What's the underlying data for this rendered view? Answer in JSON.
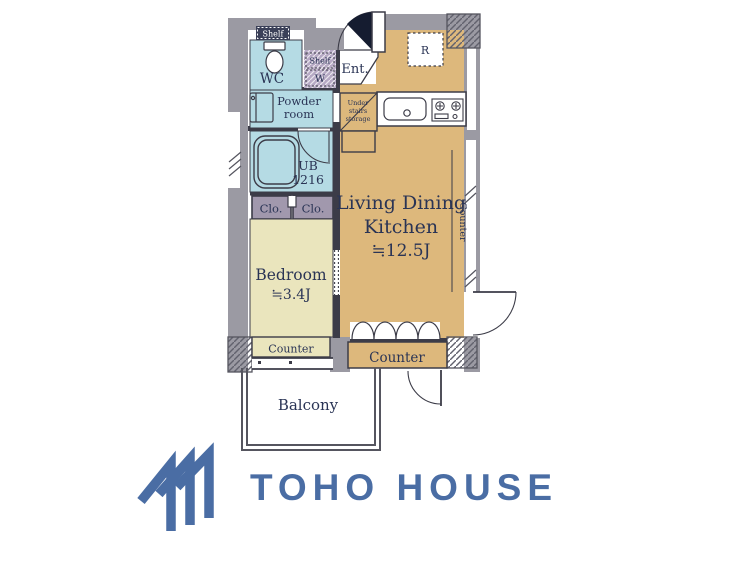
{
  "floor_plan": {
    "labels": {
      "shelf_top": "Shelf",
      "wc": "WC",
      "shelf_w_line1": "Shelf",
      "shelf_w_line2": "W",
      "entrance": "Ent.",
      "refrigerator": "R",
      "powder_line1": "Powder",
      "powder_line2": "room",
      "under_stairs_line1": "Under",
      "under_stairs_line2": "stairs",
      "under_stairs_line3": "storage",
      "unit_bath_line1": "UB",
      "unit_bath_line2": "1216",
      "closet_left": "Clo.",
      "closet_right": "Clo.",
      "ldk_line1": "Living Dining",
      "ldk_line2": "Kitchen",
      "ldk_size": "≒12.5J",
      "counter_right": "Counter",
      "bedroom_line1": "Bedroom",
      "bedroom_size": "≒3.4J",
      "counter_bedroom": "Counter",
      "counter_ldk": "Counter",
      "balcony": "Balcony"
    },
    "colors": {
      "wall": "#9b9aa3",
      "room_blue": "#b5dbe4",
      "room_tan": "#ddb87c",
      "room_cream": "#eae5bd",
      "closet_purple": "#a198ad",
      "shelf_lavender": "#b6a9c4",
      "shelf_dark": "#3b4058",
      "line_dark": "#3c3c48",
      "text_navy": "#2a3455",
      "door_dark": "#151c30"
    }
  },
  "logo": {
    "text": "TOHO HOUSE",
    "color": "#4a6da4",
    "mark": "three-chevron-roof"
  }
}
